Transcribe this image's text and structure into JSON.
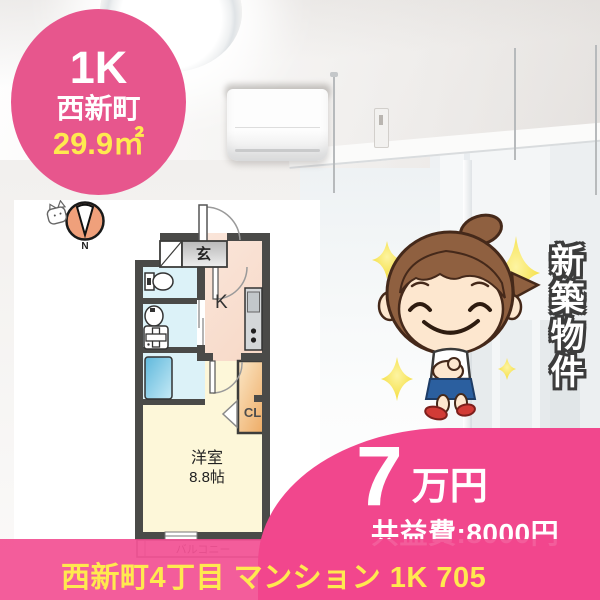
{
  "badge": {
    "layout_type": "1K",
    "town_name": "西新町",
    "floor_area": "29.9㎡"
  },
  "floorplan": {
    "compass_label": "N",
    "entrance_label": "玄",
    "kitchen_label": "K",
    "closet_label": "CL",
    "room_label": "洋室",
    "room_size_label": "8.8帖",
    "balcony_label": "バルコニー"
  },
  "banner": {
    "text": "新築物件"
  },
  "price": {
    "rent_amount": "7",
    "rent_unit": "万円",
    "common_fee": "共益費:8000円"
  },
  "footer": {
    "title": "西新町4丁目 マンション 1K 705"
  },
  "colors": {
    "badge_pink": "#e7568d",
    "ribbon_pink": "#f1478d",
    "accent_yellow": "#ffe94f",
    "plan_wall_gray": "#4a4a48",
    "compass_orange": "#efa07b"
  }
}
